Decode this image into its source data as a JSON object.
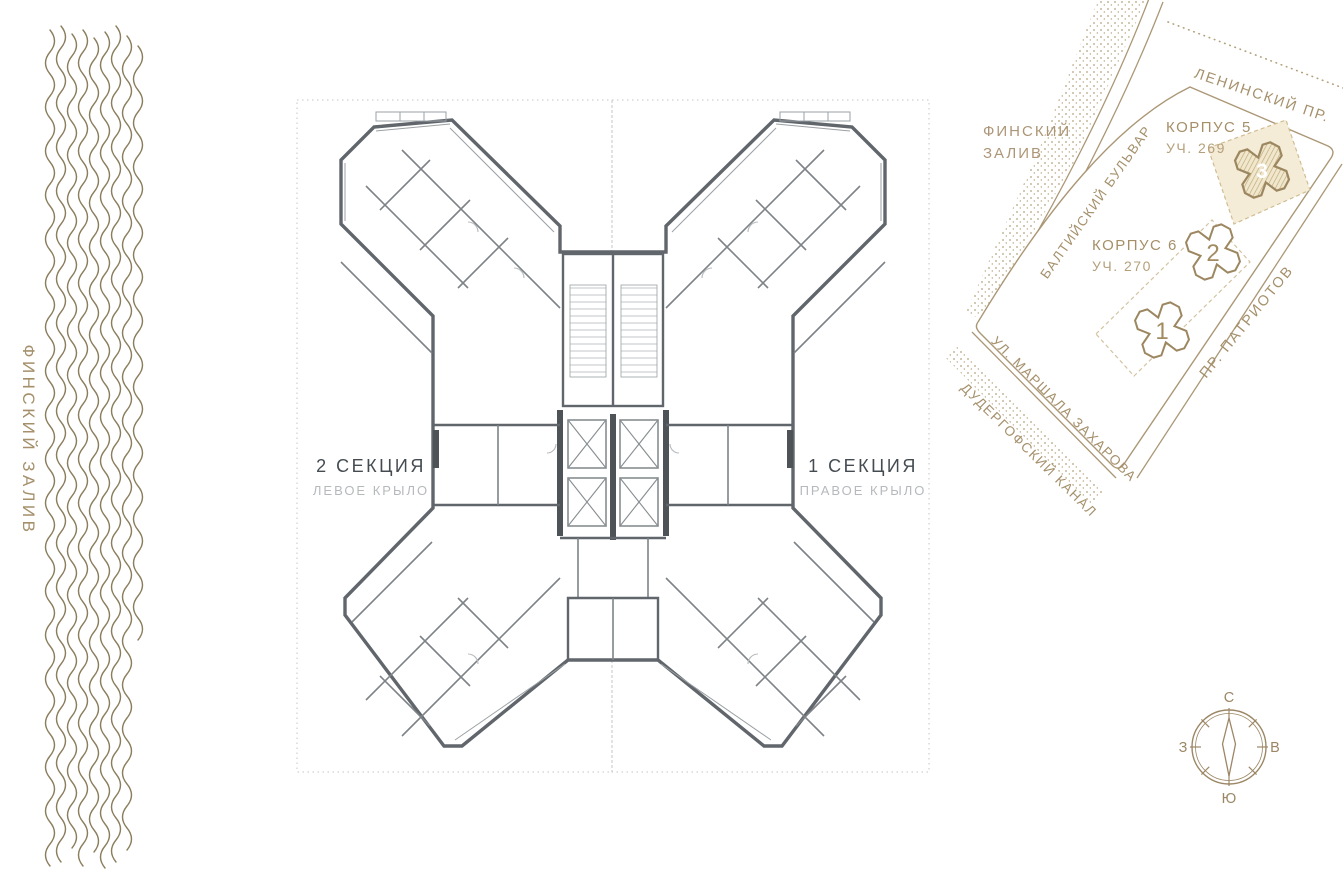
{
  "shore": {
    "label": "ФИНСКИЙ ЗАЛИВ"
  },
  "plan": {
    "section_left": {
      "title": "2 СЕКЦИЯ",
      "subtitle": "ЛЕВОЕ КРЫЛО"
    },
    "section_right": {
      "title": "1 СЕКЦИЯ",
      "subtitle": "ПРАВОЕ КРЫЛО"
    }
  },
  "map": {
    "gulf": {
      "line1": "ФИНСКИЙ",
      "line2": "ЗАЛИВ"
    },
    "streets": {
      "baltiysky": "БАЛТИЙСКИЙ БУЛЬВАР",
      "leninsky": "ЛЕНИНСКИЙ ПР.",
      "patriotov": "ПР. ПАТРИОТОВ",
      "zakharova": "УЛ. МАРШАЛА ЗАХАРОВА",
      "kanal": "ДУДЕРГОФСКИЙ КАНАЛ"
    },
    "building3": {
      "number": "3",
      "korpus": "КОРПУС 5",
      "plot": "УЧ. 269"
    },
    "building2": {
      "number": "2",
      "korpus": "КОРПУС 6",
      "plot": "УЧ. 270"
    },
    "building1": {
      "number": "1"
    }
  },
  "compass": {
    "north": "С",
    "south": "Ю",
    "west": "З",
    "east": "В"
  },
  "colors": {
    "accent_tan": "#a5906b",
    "wave": "#8b7e5d",
    "plan_wall": "#60666b",
    "plan_light": "#9aa0a4",
    "muted_label": "#b6babd",
    "highlight_fill": "#f4ecd7"
  }
}
